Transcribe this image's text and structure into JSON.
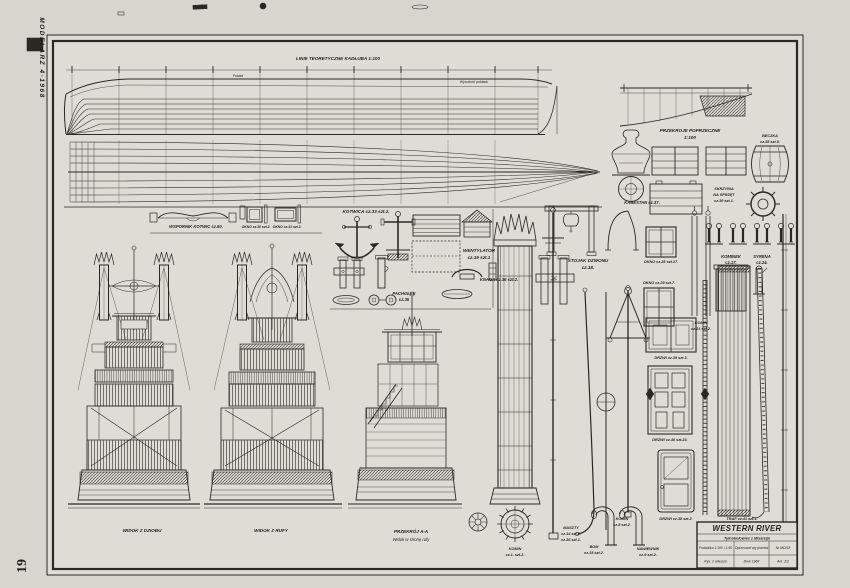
{
  "page": {
    "magazine": "MODELARZ 4·1968",
    "page_number": "19"
  },
  "lines_plan": {
    "title": "LINIE TEORETYCZNE KADŁUBA  1:100",
    "deck_label": "Pokład",
    "height_label": "Wysokość pokładu"
  },
  "sections_plan": {
    "line1": "PRZEKROJE POPRZECZNE",
    "line2": "1:100"
  },
  "parts": {
    "kabestan": "KABESTAN cz.37.",
    "beczka1": "BECZKA",
    "beczka2": "cz.38 szt.9.",
    "skrzynia1": "SKRZYNIA",
    "skrzynia2": "NA SPRZĘT",
    "skrzynia3": "cz.39 szt.1.",
    "wspornik": "WSPORNIK KOTWIC  cz.50.",
    "okno30": "OKNO cz.30 szt.2.",
    "okno31": "OKNO cz.31 szt.2.",
    "kotwica": "KOTWICA  cz.33 szt.2.",
    "wentylator1": "WENTYLATOR",
    "wentylator2": "cz.19  szt.1",
    "pacholek1": "PACHOŁEK",
    "pacholek2": "cz.35",
    "knaga": "KNAGA  cz.36 szt.2.",
    "stojak1": "STOJAK DZWONU",
    "stojak2": "cz.18.",
    "okno28": "OKNO cz.28 szt.17.",
    "okno29": "OKNO cz.29 szt.7.",
    "komin21_1": "KOMIN",
    "komin21_2": "cz.21 szt.2.",
    "kominek1": "KOMINEK",
    "kominek2": "cz.17.",
    "syrena1": "SYRENA",
    "syrena2": "cz.24.",
    "komin1_1": "KOMIN",
    "komin1_2": "cz.1. szt.2.",
    "maszty1": "MASZTY",
    "maszty2": "cz.14 szt.2.",
    "maszty3": "cz.16 szt.1.",
    "bom1": "BOM",
    "bom2": "cz.15 szt.2.",
    "komin8_1": "KOMIN",
    "komin8_2": "cz.8 szt.2.",
    "nawiewnik1": "NAWIEWNIK",
    "nawiewnik2": "cz.9  szt.2.",
    "drzwi39": "DRZWI cz.39 szt.3.",
    "drzwi40": "DRZWI cz.40 szt.24.",
    "drzwi38": "DRZWI cz.38 szt.2.",
    "trap": "TRAP  cz.41 szt.1."
  },
  "views": {
    "bow": "WIDOK Z DZIOBU",
    "stern": "WIDOK Z RUFY",
    "section1": "PRZEKRÓJ A-A",
    "section2": "Widok w stronę rufy"
  },
  "title_block": {
    "name": "WESTERN RIVER",
    "subtitle": "Tylnokołowiec z Missisipi",
    "cells": [
      "Podziałka 1:100 i 1:50",
      "Opracował wg planów",
      "Nr MD/18",
      "Rys. 2 arkusze",
      "Druk 1968",
      "Ark. 2/2"
    ]
  }
}
